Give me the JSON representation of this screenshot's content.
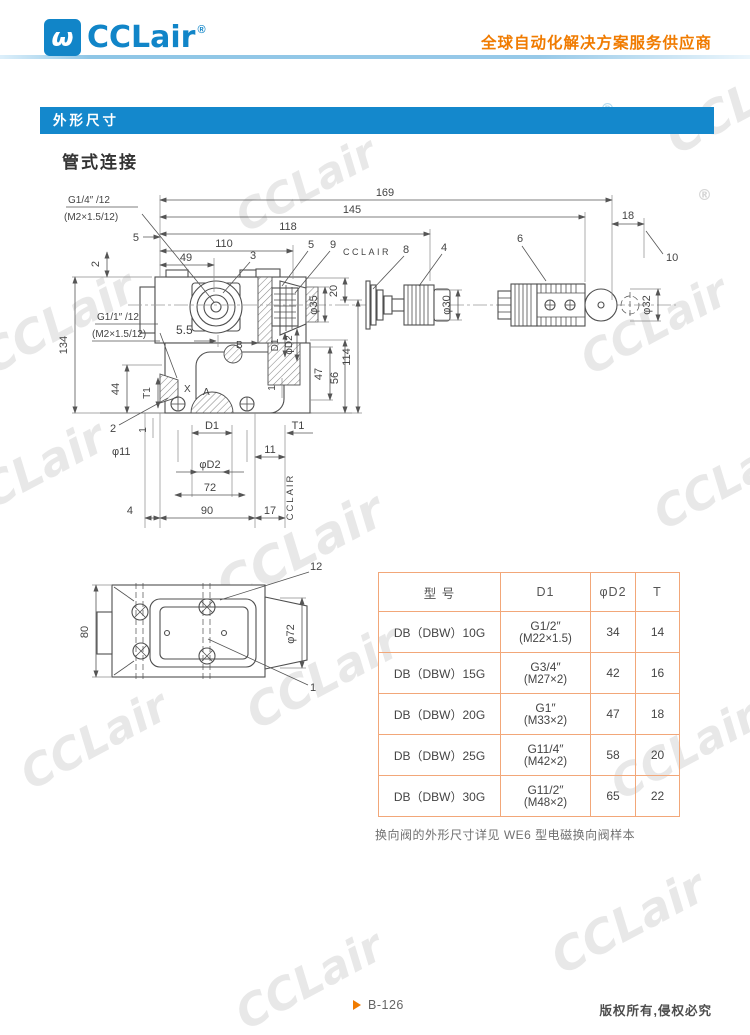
{
  "header": {
    "logo": "CCLair",
    "reg": "®",
    "tagline": "全球自动化解决方案服务供应商"
  },
  "section": {
    "title": "外形尺寸",
    "subtitle": "管式连接"
  },
  "drawing": {
    "labels": {
      "g14": "G1/4″ /12",
      "g14b": "(M2×1.5/12)",
      "g11": "G1/1″ /12",
      "g11b": "(M2×1.5/12)",
      "d169": "169",
      "d145": "145",
      "d118": "118",
      "d110": "110",
      "d49": "49",
      "d5t": "5",
      "d2t": "2",
      "d18": "18",
      "c10": "10",
      "c3": "3",
      "c5": "5",
      "c9": "9",
      "c8": "8",
      "c4": "4",
      "c6": "6",
      "cclair": "CCLAIR",
      "cclairv": "CCLAIR",
      "d20": "20",
      "p35": "φ35",
      "p30": "φ30",
      "p32": "φ32",
      "d134": "134",
      "d55": "5.5",
      "d44": "44",
      "t1l": "T1",
      "xp": "X",
      "ap": "A",
      "bp": "B",
      "d1v": "D1",
      "pd2v": "φD2",
      "d114": "114",
      "d47": "47",
      "d56": "56",
      "d1a": "1",
      "c2": "2",
      "d1b": "1",
      "p11": "φ11",
      "d1bot": "D1",
      "t1bot": "T1",
      "d11": "11",
      "pd2bot": "φD2",
      "d72": "72",
      "d90": "90",
      "d4": "4",
      "d17": "17",
      "d80": "80",
      "p72": "φ72",
      "c12": "12",
      "c1": "1"
    }
  },
  "table": {
    "headers": [
      "型 号",
      "D1",
      "φD2",
      "T"
    ],
    "rows": [
      {
        "model": "DB（DBW）10G",
        "d1": "G1/2″",
        "d1sub": "(M22×1.5)",
        "d2": "34",
        "t": "14"
      },
      {
        "model": "DB（DBW）15G",
        "d1": "G3/4″",
        "d1sub": "(M27×2)",
        "d2": "42",
        "t": "16"
      },
      {
        "model": "DB（DBW）20G",
        "d1": "G1″",
        "d1sub": "(M33×2)",
        "d2": "47",
        "t": "18"
      },
      {
        "model": "DB（DBW）25G",
        "d1": "G11/4″",
        "d1sub": "(M42×2)",
        "d2": "58",
        "t": "20"
      },
      {
        "model": "DB（DBW）30G",
        "d1": "G11/2″",
        "d1sub": "(M48×2)",
        "d2": "65",
        "t": "22"
      }
    ]
  },
  "note": {
    "text": "换向阀的外形尺寸详见 WE6 型电磁换向阀样本"
  },
  "footer": {
    "page": "B-126",
    "copyright": "版权所有,侵权必究"
  },
  "watermark": {
    "text": "CCLair",
    "reg": "®"
  },
  "colors": {
    "brand_blue": "#1185c8",
    "bar_blue": "#1488cc",
    "accent_orange": "#f07b00",
    "table_border": "#f2a779"
  }
}
